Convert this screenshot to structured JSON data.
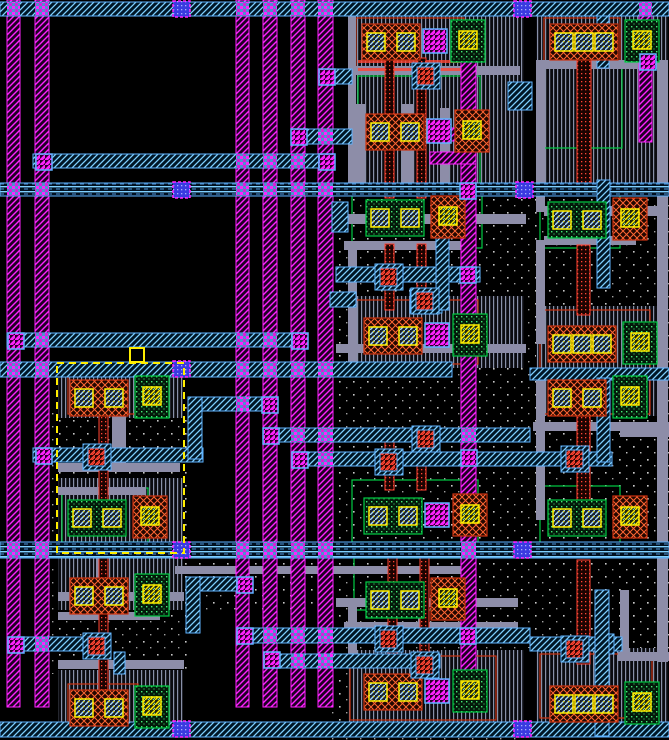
{
  "app": {
    "view": "ic-layout-canvas"
  },
  "canvas": {
    "width": 669,
    "height": 740
  },
  "colors": {
    "background": "#000000",
    "metal2": "#ff22ff",
    "metal3": "#5fb3ff",
    "metal3_line": "#7fd0ff",
    "metal1": "#8d8da8",
    "poly": "#ff4433",
    "pdiff_stroke": "#cc3311",
    "pdiff_line": "#ff6633",
    "ndiff_stroke": "#00cc44",
    "ndiff_dot": "#44ee77",
    "contact": "#ffee00",
    "via_blue": "#3a3ae0",
    "well_dot": "#c8c8c8",
    "selection": "#ffee00"
  },
  "layout_data": {
    "rails": [
      [
        7,
        0,
        13,
        707
      ],
      [
        35,
        0,
        14,
        707
      ],
      [
        236,
        0,
        13,
        707
      ],
      [
        263,
        0,
        14,
        707
      ],
      [
        291,
        0,
        14,
        707
      ],
      [
        318,
        0,
        15,
        707
      ],
      [
        461,
        44,
        15,
        666
      ],
      [
        639,
        10,
        13,
        132
      ]
    ],
    "bars": [
      [
        0,
        2,
        669,
        14
      ],
      [
        33,
        154,
        298,
        14
      ],
      [
        319,
        69,
        33,
        15
      ],
      [
        291,
        129,
        61,
        15
      ],
      [
        336,
        267,
        144,
        15
      ],
      [
        330,
        292,
        26,
        15
      ],
      [
        410,
        289,
        32,
        24
      ],
      [
        7,
        333,
        301,
        14
      ],
      [
        0,
        362,
        452,
        15
      ],
      [
        188,
        397,
        90,
        14
      ],
      [
        263,
        428,
        267,
        14
      ],
      [
        292,
        452,
        320,
        14
      ],
      [
        530,
        368,
        139,
        12
      ],
      [
        186,
        577,
        66,
        14
      ],
      [
        237,
        628,
        293,
        15
      ],
      [
        530,
        637,
        92,
        14
      ],
      [
        264,
        654,
        176,
        14
      ],
      [
        0,
        722,
        669,
        15
      ],
      [
        8,
        637,
        100,
        14
      ],
      [
        33,
        448,
        170,
        14
      ],
      [
        508,
        82,
        24,
        28
      ],
      [
        332,
        202,
        16,
        30
      ],
      [
        598,
        634,
        16,
        20
      ]
    ],
    "bundles": [
      [
        0,
        183,
        669,
        13
      ],
      [
        0,
        542,
        669,
        16
      ]
    ],
    "vstraps": [
      [
        188,
        397,
        14,
        62
      ],
      [
        186,
        577,
        14,
        56
      ],
      [
        114,
        652,
        11,
        22
      ],
      [
        597,
        16,
        12,
        52
      ],
      [
        597,
        180,
        13,
        108
      ],
      [
        597,
        378,
        13,
        84
      ],
      [
        595,
        590,
        14,
        146
      ],
      [
        436,
        196,
        13,
        114
      ]
    ],
    "wires": [
      [
        58,
        463,
        122,
        9
      ],
      [
        58,
        487,
        88,
        8
      ],
      [
        112,
        412,
        14,
        54
      ],
      [
        58,
        592,
        126,
        9
      ],
      [
        58,
        612,
        102,
        8
      ],
      [
        96,
        556,
        12,
        38
      ],
      [
        58,
        660,
        126,
        9
      ],
      [
        348,
        12,
        8,
        176
      ],
      [
        348,
        66,
        172,
        9
      ],
      [
        356,
        104,
        9,
        84
      ],
      [
        402,
        104,
        12,
        84
      ],
      [
        440,
        108,
        9,
        78
      ],
      [
        336,
        214,
        190,
        10
      ],
      [
        344,
        241,
        118,
        9
      ],
      [
        348,
        250,
        9,
        120
      ],
      [
        336,
        344,
        190,
        9
      ],
      [
        175,
        566,
        290,
        8
      ],
      [
        336,
        598,
        182,
        9
      ],
      [
        344,
        622,
        174,
        8
      ],
      [
        348,
        600,
        9,
        58
      ],
      [
        418,
        598,
        11,
        46
      ],
      [
        536,
        60,
        132,
        9
      ],
      [
        536,
        64,
        9,
        148
      ],
      [
        657,
        62,
        11,
        600
      ],
      [
        544,
        206,
        122,
        10
      ],
      [
        544,
        236,
        92,
        9
      ],
      [
        536,
        240,
        9,
        104
      ],
      [
        533,
        422,
        136,
        9
      ],
      [
        536,
        378,
        9,
        142
      ],
      [
        620,
        428,
        49,
        9
      ],
      [
        620,
        590,
        9,
        64
      ],
      [
        618,
        652,
        51,
        9
      ],
      [
        56,
        730,
        560,
        4
      ]
    ],
    "polys": [
      [
        385,
        58,
        9,
        140
      ],
      [
        417,
        58,
        9,
        140
      ],
      [
        385,
        244,
        9,
        66
      ],
      [
        417,
        244,
        9,
        66
      ],
      [
        385,
        430,
        9,
        60
      ],
      [
        417,
        430,
        9,
        60
      ],
      [
        388,
        556,
        9,
        110
      ],
      [
        420,
        556,
        9,
        110
      ],
      [
        577,
        42,
        14,
        150
      ],
      [
        577,
        245,
        13,
        70
      ],
      [
        577,
        376,
        13,
        142
      ],
      [
        577,
        560,
        13,
        104
      ],
      [
        99,
        412,
        9,
        96
      ],
      [
        99,
        556,
        9,
        40
      ],
      [
        99,
        604,
        9,
        92
      ]
    ],
    "redlines": [
      [
        358,
        60,
        104,
        3
      ],
      [
        358,
        68,
        104,
        3
      ]
    ],
    "dense": [
      [
        58,
        366,
        125,
        52
      ],
      [
        58,
        478,
        125,
        78
      ],
      [
        58,
        556,
        125,
        54
      ],
      [
        58,
        670,
        125,
        52
      ],
      [
        348,
        16,
        176,
        172
      ],
      [
        348,
        296,
        176,
        72
      ],
      [
        348,
        650,
        176,
        74
      ],
      [
        536,
        16,
        132,
        172
      ],
      [
        536,
        306,
        132,
        110
      ],
      [
        536,
        648,
        132,
        76
      ]
    ],
    "dots": [
      [
        50,
        404,
        142,
        270
      ],
      [
        184,
        540,
        150,
        70
      ],
      [
        330,
        186,
        196,
        560
      ],
      [
        524,
        188,
        145,
        460
      ],
      [
        616,
        430,
        53,
        220
      ]
    ],
    "outlines_green": [
      [
        358,
        76,
        122,
        112
      ],
      [
        352,
        192,
        130,
        56
      ],
      [
        352,
        480,
        126,
        62
      ],
      [
        354,
        558,
        120,
        52
      ],
      [
        544,
        62,
        78,
        86
      ],
      [
        540,
        194,
        80,
        54
      ],
      [
        540,
        486,
        80,
        58
      ],
      [
        62,
        488,
        86,
        54
      ]
    ],
    "outlines_orange": [
      [
        356,
        300,
        122,
        64
      ],
      [
        540,
        310,
        110,
        104
      ],
      [
        350,
        656,
        146,
        64
      ],
      [
        540,
        654,
        112,
        64
      ],
      [
        356,
        18,
        108,
        50
      ],
      [
        544,
        18,
        76,
        46
      ],
      [
        68,
        374,
        70,
        40
      ],
      [
        68,
        684,
        70,
        38
      ]
    ],
    "msegs": [
      [
        428,
        128,
        48,
        13
      ],
      [
        430,
        152,
        46,
        12
      ]
    ],
    "cells": [
      {
        "v": "p",
        "x": 70,
        "y": 380,
        "nc": 2,
        "via": false,
        "right": "g"
      },
      {
        "v": "n",
        "x": 68,
        "y": 500,
        "nc": 2,
        "via": false,
        "right": "o"
      },
      {
        "v": "p",
        "x": 70,
        "y": 578,
        "nc": 2,
        "via": false,
        "right": "g"
      },
      {
        "v": "p",
        "x": 70,
        "y": 690,
        "nc": 2,
        "via": false,
        "right": "g"
      },
      {
        "v": "p",
        "x": 362,
        "y": 24,
        "nc": 2,
        "via": true,
        "right": "g"
      },
      {
        "v": "p",
        "x": 366,
        "y": 114,
        "nc": 2,
        "via": true,
        "right": "o"
      },
      {
        "v": "n",
        "x": 366,
        "y": 200,
        "nc": 2,
        "via": false,
        "right": "o"
      },
      {
        "v": "p",
        "x": 364,
        "y": 318,
        "nc": 2,
        "via": true,
        "right": "g"
      },
      {
        "v": "n",
        "x": 364,
        "y": 498,
        "nc": 2,
        "via": true,
        "right": "o"
      },
      {
        "v": "n",
        "x": 366,
        "y": 582,
        "nc": 2,
        "via": false,
        "right": "o"
      },
      {
        "v": "p",
        "x": 364,
        "y": 674,
        "nc": 2,
        "via": true,
        "right": "g"
      },
      {
        "v": "p",
        "x": 550,
        "y": 24,
        "nc": 3,
        "via": false,
        "right": "g"
      },
      {
        "v": "n",
        "x": 548,
        "y": 202,
        "nc": 2,
        "via": false,
        "right": "o"
      },
      {
        "v": "p",
        "x": 548,
        "y": 326,
        "nc": 3,
        "via": false,
        "right": "g"
      },
      {
        "v": "p",
        "x": 548,
        "y": 380,
        "nc": 2,
        "via": false,
        "right": "g"
      },
      {
        "v": "n",
        "x": 548,
        "y": 500,
        "nc": 2,
        "via": false,
        "right": "o"
      },
      {
        "v": "p",
        "x": 550,
        "y": 686,
        "nc": 3,
        "via": false,
        "right": "g"
      }
    ],
    "red_contacts": [
      [
        380,
        268
      ],
      [
        416,
        292
      ],
      [
        88,
        448
      ],
      [
        417,
        430
      ],
      [
        380,
        453
      ],
      [
        566,
        450
      ],
      [
        88,
        637
      ],
      [
        380,
        630
      ],
      [
        566,
        640
      ],
      [
        416,
        656
      ],
      [
        417,
        67
      ]
    ],
    "vias_m2": [
      [
        36,
        154
      ],
      [
        319,
        154
      ],
      [
        262,
        397
      ],
      [
        263,
        428
      ],
      [
        292,
        452
      ],
      [
        36,
        448
      ],
      [
        8,
        333
      ],
      [
        292,
        333
      ],
      [
        8,
        637
      ],
      [
        237,
        577
      ],
      [
        237,
        628
      ],
      [
        264,
        652
      ],
      [
        319,
        69
      ],
      [
        291,
        129
      ],
      [
        460,
        267
      ],
      [
        461,
        450
      ],
      [
        460,
        628
      ],
      [
        460,
        183
      ],
      [
        640,
        54
      ]
    ],
    "vias_m3": [
      [
        173,
        1
      ],
      [
        514,
        1
      ],
      [
        173,
        182
      ],
      [
        516,
        182
      ],
      [
        173,
        361
      ],
      [
        173,
        542
      ],
      [
        514,
        542
      ],
      [
        173,
        721
      ],
      [
        514,
        721
      ]
    ],
    "selection": {
      "x": 57,
      "y": 363,
      "w": 127,
      "h": 190,
      "handle": [
        130,
        348,
        14,
        14
      ]
    }
  }
}
